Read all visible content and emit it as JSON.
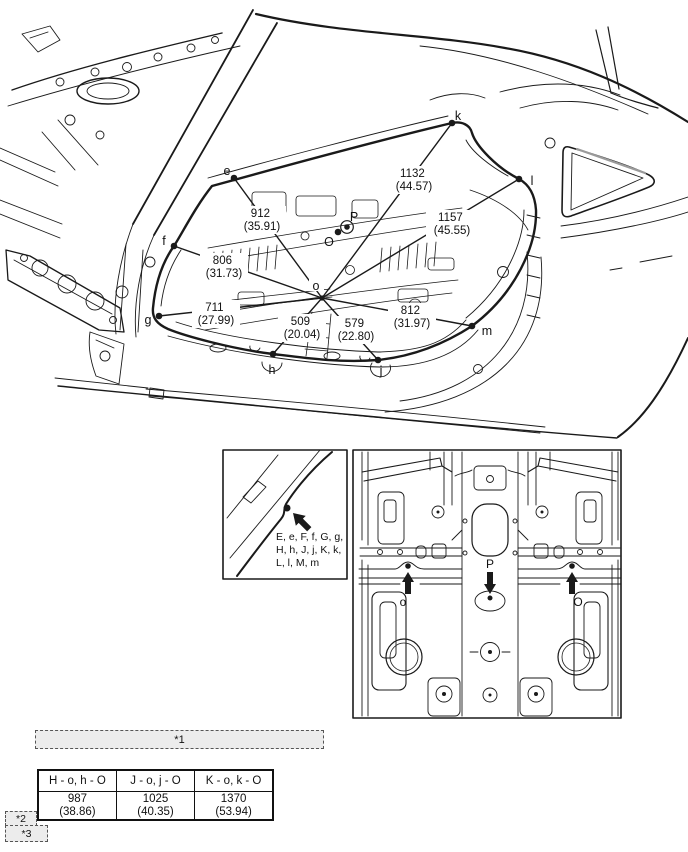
{
  "main_figure": {
    "points": {
      "e": "e",
      "f": "f",
      "g": "g",
      "h": "h",
      "j": "j",
      "k": "k",
      "l": "l",
      "m": "m",
      "o": "o",
      "O": "O",
      "P": "P"
    },
    "measurements": {
      "e_o": {
        "mm": "912",
        "inch": "(35.91)"
      },
      "f_o": {
        "mm": "806",
        "inch": "(31.73)"
      },
      "g_o": {
        "mm": "711",
        "inch": "(27.99)"
      },
      "h_o": {
        "mm": "509",
        "inch": "(20.04)"
      },
      "j_o": {
        "mm": "579",
        "inch": "(22.80)"
      },
      "k_o": {
        "mm": "1132",
        "inch": "(44.57)"
      },
      "l_o": {
        "mm": "1157",
        "inch": "(45.55)"
      },
      "m_o": {
        "mm": "812",
        "inch": "(31.97)"
      }
    }
  },
  "detail_inset": {
    "note_line1": "E, e, F, f, G, g,",
    "note_line2": "H, h, J, j, K, k,",
    "note_line3": "L, l, M, m"
  },
  "underbody_inset": {
    "points": {
      "o": "o",
      "P": "P",
      "O": "O"
    }
  },
  "footnotes": {
    "f1": "*1",
    "f2": "*2",
    "f3": "*3"
  },
  "table": {
    "columns": [
      {
        "header": "H - o, h - O",
        "mm": "987",
        "inch": "(38.86)"
      },
      {
        "header": "J - o, j - O",
        "mm": "1025",
        "inch": "(40.35)"
      },
      {
        "header": "K - o, k - O",
        "mm": "1370",
        "inch": "(53.94)"
      }
    ]
  },
  "colors": {
    "line": "#1a1a1a",
    "grey_fill": "#ececec",
    "accent_grey": "#9a9a9a"
  }
}
